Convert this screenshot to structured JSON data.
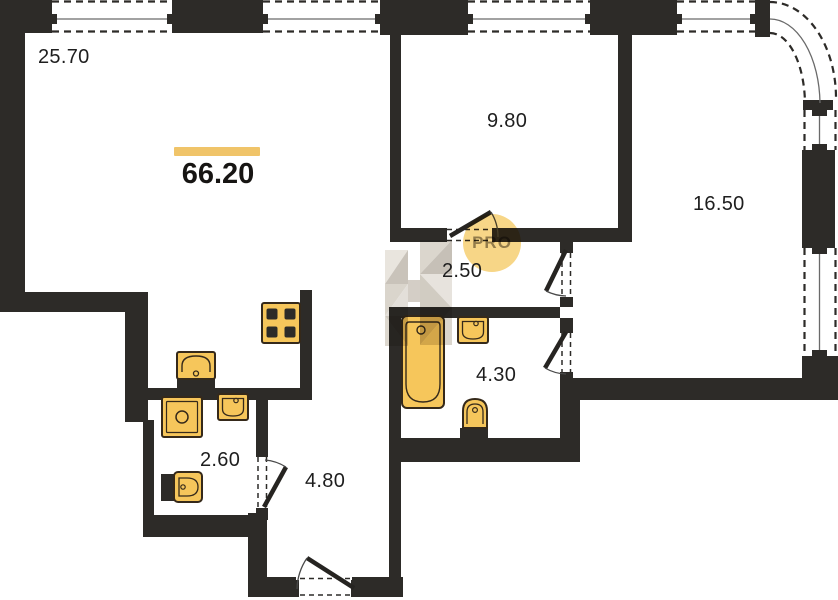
{
  "plan": {
    "title": "apartment-floor-plan",
    "total_area": "66.20",
    "rooms": [
      {
        "name": "living-room",
        "area": "25.70"
      },
      {
        "name": "bedroom",
        "area": "9.80"
      },
      {
        "name": "bedroom-2",
        "area": "16.50"
      },
      {
        "name": "inner-hall",
        "area": "2.50"
      },
      {
        "name": "bathroom",
        "area": "4.30"
      },
      {
        "name": "wc-laundry",
        "area": "2.60"
      },
      {
        "name": "entry-hall",
        "area": "4.80"
      }
    ],
    "watermark": {
      "label": "PRO"
    },
    "colors": {
      "wall": "#2d2b28",
      "fixture_fill": "#f6c65b",
      "fixture_stroke": "#35291a",
      "accent_bar": "#f0c469",
      "watermark_circle": "#f6cf72",
      "watermark_text": "#98948c"
    }
  }
}
